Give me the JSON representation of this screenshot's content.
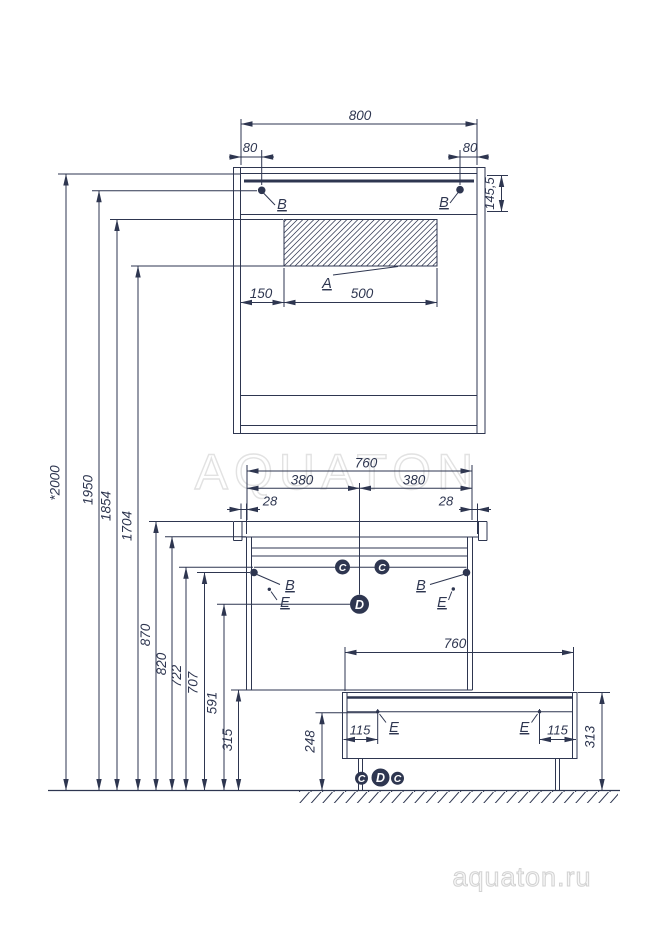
{
  "watermarks": {
    "center": "AQUATON",
    "corner": "aquaton.ru"
  },
  "mirror": {
    "width": "800",
    "offset_left": "80",
    "offset_right": "80",
    "lamp_height": "145,5",
    "glass_offset": "150",
    "glass_width": "500",
    "label_glass": "A",
    "label_hole_left": "B",
    "label_hole_right": "B"
  },
  "vanity": {
    "width": "760",
    "half_left": "380",
    "half_right": "380",
    "overhang_left": "28",
    "overhang_right": "28",
    "label_hole_left": "B",
    "label_hole_right": "B",
    "label_c_left": "C",
    "label_c_right": "C",
    "label_d": "D",
    "label_e_left": "E",
    "label_e_right": "E"
  },
  "base": {
    "width": "760",
    "leg_offset_left": "115",
    "leg_offset_right": "115",
    "height_front": "248",
    "height_total": "313",
    "label_e_left": "E",
    "label_e_right": "E",
    "label_c_left": "C",
    "label_d": "D",
    "label_c_right": "C"
  },
  "heights": {
    "total": "*2000",
    "lamp": "1950",
    "holes": "1854",
    "glass_bottom": "1704",
    "countertop": "870",
    "cabinet_top": "820",
    "rail": "722",
    "holes_lower": "707",
    "d_level": "591",
    "cabinet_bottom": "315"
  },
  "colors": {
    "line": "#2e3650",
    "watermark": "#e2e2e2"
  }
}
